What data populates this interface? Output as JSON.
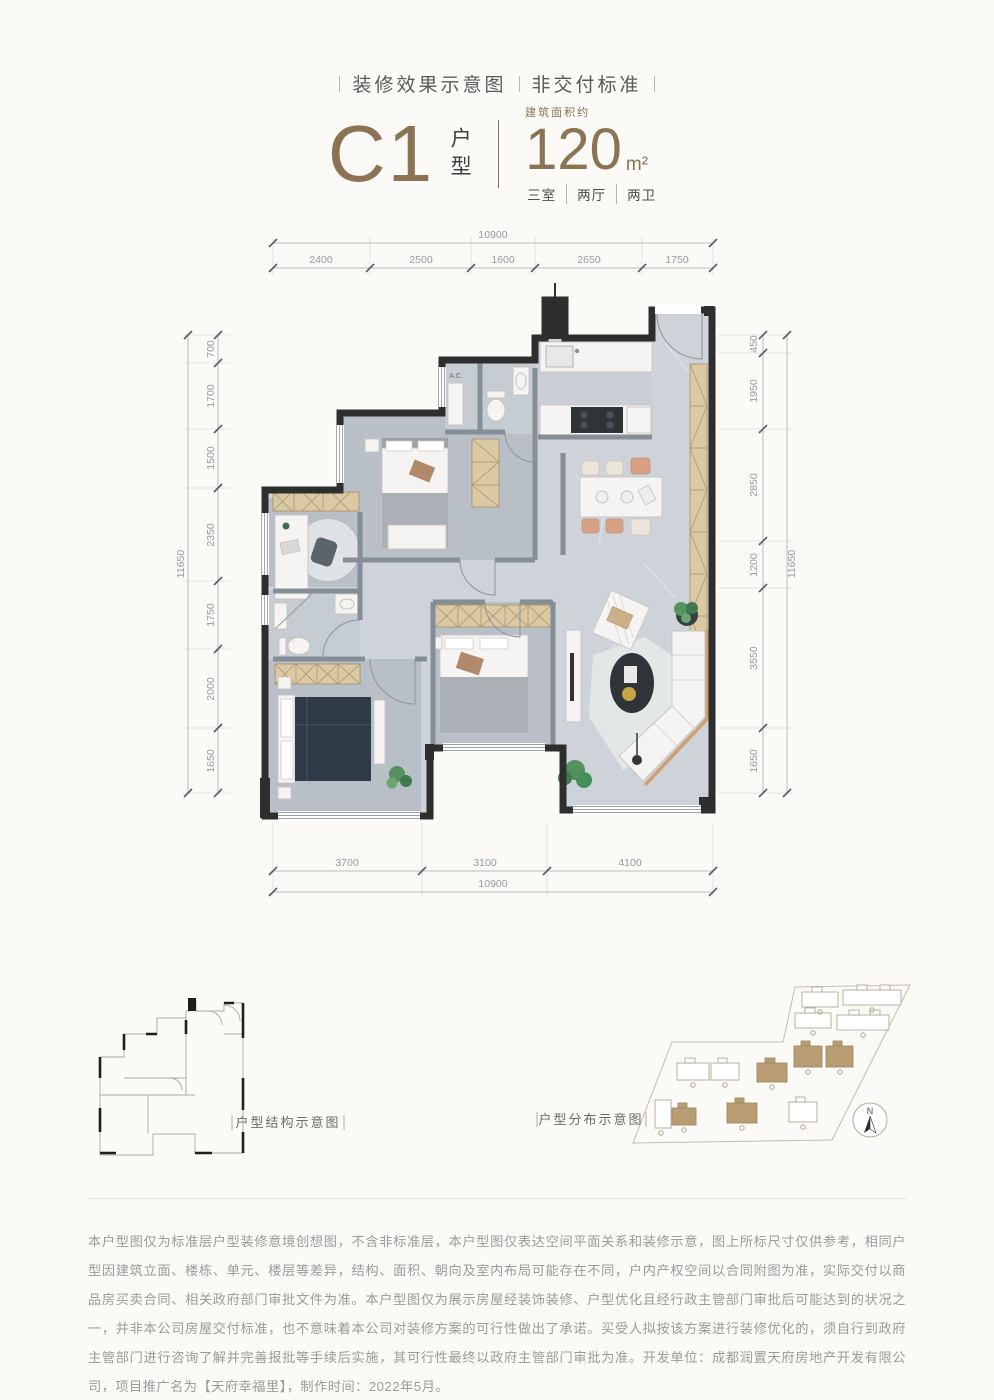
{
  "header": {
    "left": "装修效果示意图",
    "right": "非交付标准"
  },
  "title": {
    "code": "C1",
    "type_vertical": "户型",
    "area_label": "建筑面积约",
    "area_value": "120",
    "area_unit": "m²",
    "rooms": [
      "三室",
      "两厅",
      "两卫"
    ]
  },
  "floorplan": {
    "ac_label": "A.C."
  },
  "dims": {
    "top_total": "10900",
    "top_segments": [
      "2400",
      "2500",
      "1600",
      "2650",
      "1750"
    ],
    "bottom_total": "10900",
    "bottom_segments": [
      "3700",
      "3100",
      "4100"
    ],
    "left_total": "11650",
    "left_segments": [
      "700",
      "1700",
      "1500",
      "2350",
      "1750",
      "2000",
      "1650"
    ],
    "right_total": "11650",
    "right_segments": [
      "450",
      "1950",
      "2850",
      "1200",
      "3550",
      "1650"
    ]
  },
  "diagrams": {
    "structure_label": "户型结构示意图",
    "distribution_label": "户型分布示意图",
    "compass_n": "N"
  },
  "disclaimer": "本户型图仅为标准层户型装修意境创想图，不含非标准层，本户型图仅表达空间平面关系和装修示意，图上所标尺寸仅供参考，相同户型因建筑立面、楼栋、单元、楼层等差异，结构、面积、朝向及室内布局可能存在不同，户内产权空间以合同附图为准，实际交付以商品房买卖合同、相关政府部门审批文件为准。本户型图仅为展示房屋经装饰装修、户型优化且经行政主管部门审批后可能达到的状况之一，并非本公司房屋交付标准，也不意味着本公司对装修方案的可行性做出了承诺。买受人拟按该方案进行装修优化的，须自行到政府主管部门进行咨询了解并完善报批等手续后实施，其可行性最终以政府主管部门审批为准。开发单位：成都润置天府房地产开发有限公司，项目推广名为【天府幸福里】，制作时间：2022年5月。",
  "colors": {
    "accent": "#8c7354",
    "wall": "#2e2e2e",
    "cabinet_tan": "#dbc9a3",
    "floor_marble": "#cdd3d8",
    "bed_navy": "#2f3a47"
  }
}
